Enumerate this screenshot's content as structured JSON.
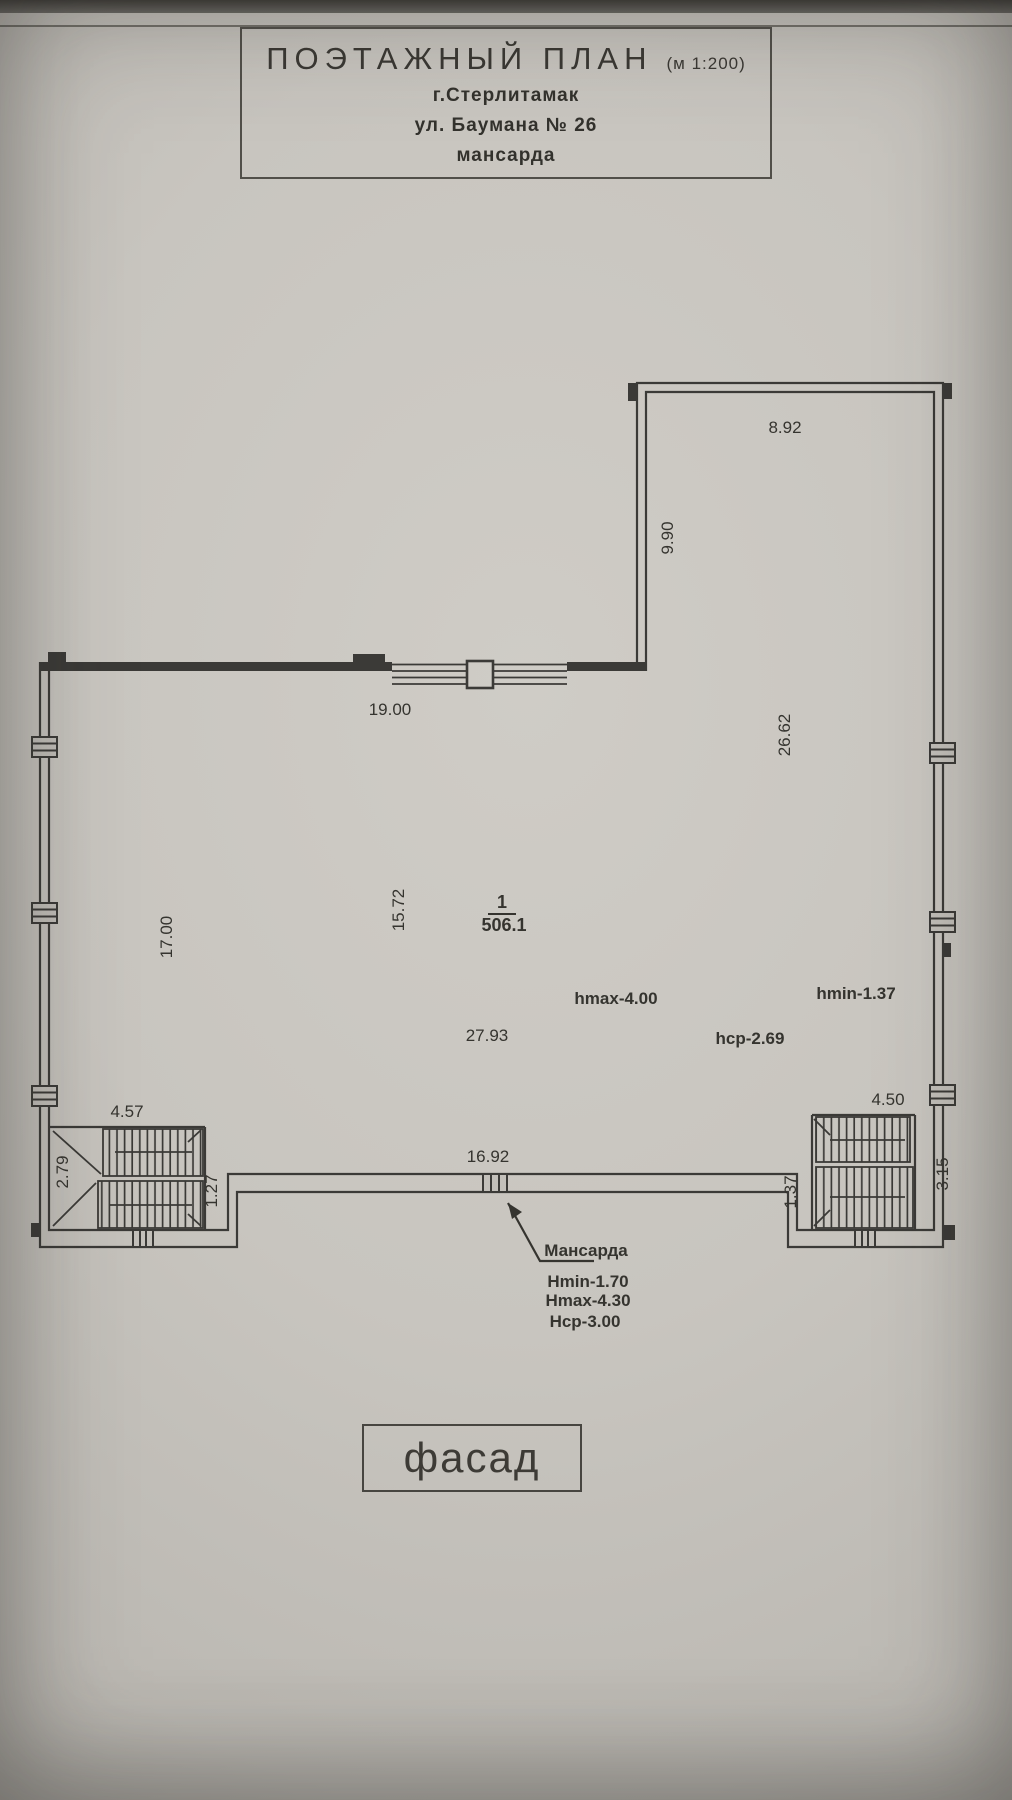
{
  "title_block": {
    "title": "ПОЭТАЖНЫЙ ПЛАН",
    "scale": "(м 1:200)",
    "city": "г.Стерлитамак",
    "address": "ул. Баумана № 26",
    "level": "мансарда"
  },
  "room": {
    "number": "1",
    "area": "506.1"
  },
  "dimensions": {
    "top_wing_width": "8.92",
    "top_wing_height": "9.90",
    "right_side": "26.62",
    "main_top": "19.00",
    "left_side": "17.00",
    "interior_depth": "15.72",
    "interior_width": "27.93",
    "left_stairs_width": "4.57",
    "left_stairs_left": "2.79",
    "left_stairs_right": "1.27",
    "bottom_center": "16.92",
    "right_stairs_width": "4.50",
    "right_stairs_left": "1.37",
    "right_stairs_right": "3.15"
  },
  "heights": {
    "hmax": "hmax-4.00",
    "hmin": "hmin-1.37",
    "havg": "hср-2.69"
  },
  "callout": {
    "label": "Мансарда",
    "hmin": "Hmin-1.70",
    "hmax": "Hmax-4.30",
    "havg": "Hср-3.00"
  },
  "facade_label": "фасад",
  "colors": {
    "paper": "#c8c5bf",
    "ink": "#3b3a37"
  }
}
